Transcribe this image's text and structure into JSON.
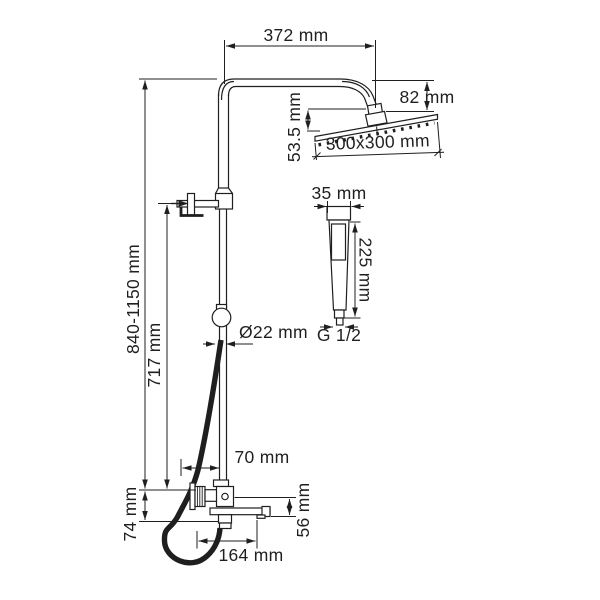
{
  "drawing": {
    "type": "technical-dimension-drawing",
    "subject": "shower-column-system",
    "colors": {
      "line": "#1f1f1f",
      "background": "#ffffff"
    }
  },
  "labels": {
    "top_width": "372 mm",
    "head_drop": "82 mm",
    "head_joint_height": "53.5 mm",
    "head_size": "300x300 mm",
    "column_height": "840-1150 mm",
    "bracket_to_mixer": "717 mm",
    "pipe_diameter": "Ø22 mm",
    "handshower_width": "35 mm",
    "handshower_length": "225 mm",
    "handshower_thread": "G 1/2",
    "wall_to_column": "70 mm",
    "spout_drop": "56 mm",
    "mixer_to_outlet": "74 mm",
    "spout_reach": "164 mm"
  }
}
